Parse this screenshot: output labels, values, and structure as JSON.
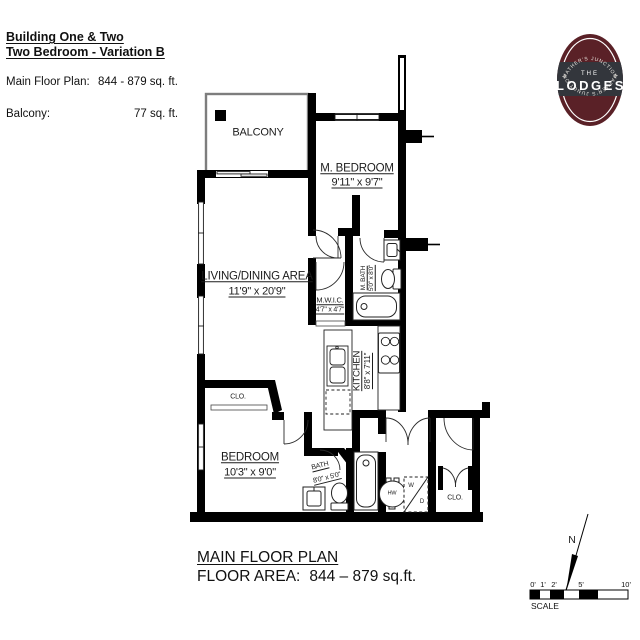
{
  "header": {
    "title_line1": "Building One & Two",
    "title_line2": "Two Bedroom - Variation B",
    "main_floor_label": "Main Floor Plan:",
    "main_floor_value": "844 - 879 sq. ft.",
    "balcony_label": "Balcony:",
    "balcony_value": "77 sq. ft."
  },
  "logo": {
    "arc_top": "MATHER'S JUNCTION",
    "the_word": "THE",
    "name": "LODGES",
    "arc_bottom": "MATHER'S JUNCTION"
  },
  "rooms": {
    "balcony": {
      "name": "BALCONY"
    },
    "m_bedroom": {
      "name": "M. BEDROOM",
      "dims": "9'11\" x 9'7\""
    },
    "living": {
      "name": "LIVING/DINING AREA",
      "dims": "11'9\" x 20'9\""
    },
    "mwic": {
      "name": "M.W.I.C.",
      "dims": "4'7\" x 4'7\""
    },
    "m_bath": {
      "name": "M. BATH",
      "dims": "5'0\" x 8'0\""
    },
    "kitchen": {
      "name": "KITCHEN",
      "dims": "8'8\" x 7'11\""
    },
    "bedroom": {
      "name": "BEDROOM",
      "dims": "10'3\" x 9'0\""
    },
    "bath": {
      "name": "BATH",
      "dims": "8'0\" x 5'0\""
    },
    "closet_bedroom": {
      "name": "CLO."
    },
    "closet_entry": {
      "name": "CLO."
    }
  },
  "fixtures": {
    "hot_water": "HW",
    "washer": "W",
    "dryer": "D"
  },
  "footer": {
    "plan_title": "MAIN FLOOR PLAN",
    "floor_area_label": "FLOOR AREA:",
    "floor_area_value": "844 – 879 sq.ft."
  },
  "compass": {
    "north": "N"
  },
  "scale_bar": {
    "tick_labels": [
      "0'",
      "1'",
      "2'",
      "5'",
      "10'"
    ],
    "caption": "SCALE"
  },
  "colors": {
    "wall": "#000000",
    "balcony_wall": "#7d7d7d",
    "logo_maroon": "#5a2127",
    "logo_band": "#33363c",
    "background": "#ffffff"
  }
}
